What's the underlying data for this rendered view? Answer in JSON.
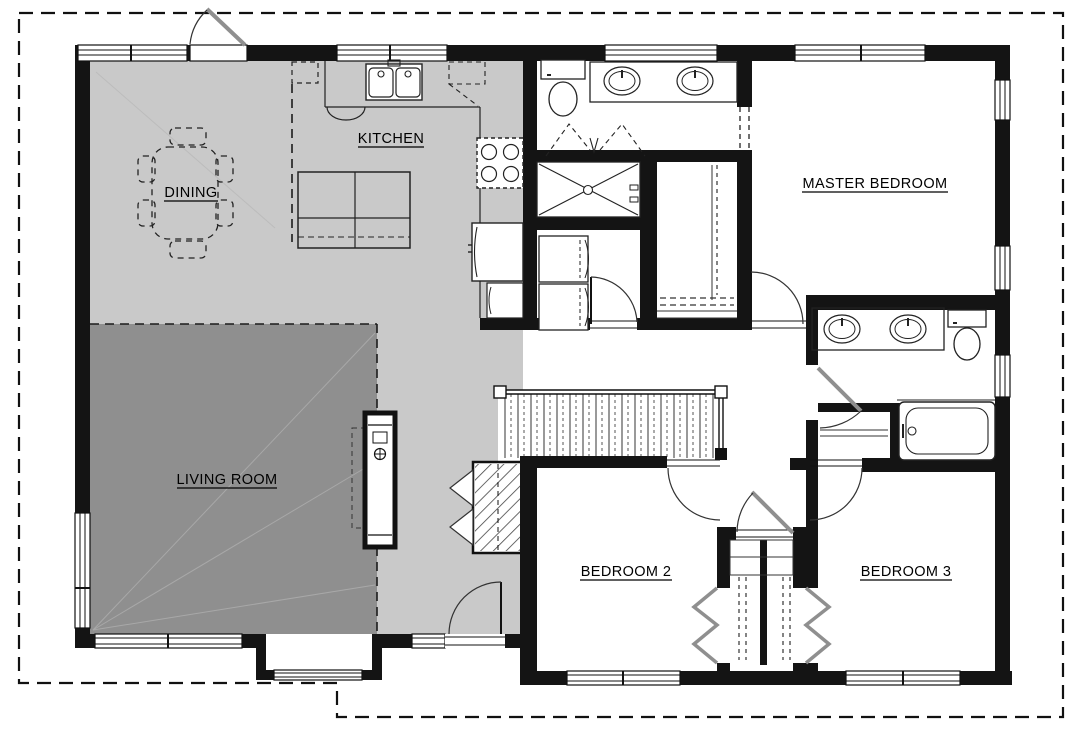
{
  "title": "floor-plan",
  "labels": {
    "kitchen": "KITCHEN",
    "dining": "DINING",
    "living_room": "LIVING ROOM",
    "master_bedroom": "MASTER BEDROOM",
    "bedroom_2": "BEDROOM 2",
    "bedroom_3": "BEDROOM 3"
  },
  "colors": {
    "background": "#ffffff",
    "floor_light": "#c9c9c9",
    "floor_dark": "#8f8f8f",
    "wall": "#141414",
    "line": "#222222",
    "door_leaf": "#8f8f8f"
  }
}
